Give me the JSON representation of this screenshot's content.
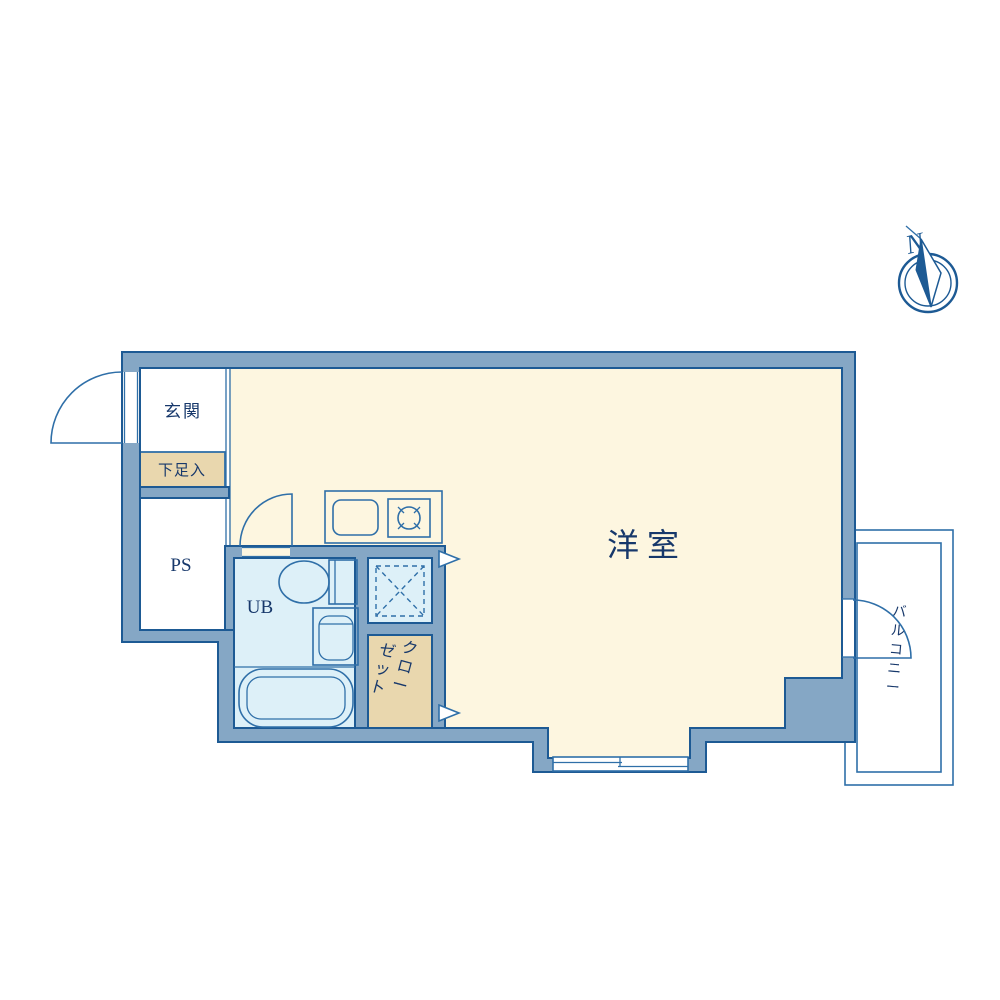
{
  "rooms": {
    "entrance": "玄関",
    "shoe_storage": "下足入",
    "pipe_space": "PS",
    "unit_bath": "UB",
    "closet_line1": "クロー",
    "closet_line2": "ゼット",
    "main_room": "洋室",
    "balcony": "バルコニー"
  },
  "compass": {
    "north": "N"
  },
  "colors": {
    "wall_fill": "#85a7c5",
    "wall_outline": "#1d5a94",
    "line": "#2f6fa8",
    "floor_cream": "#fdf6e0",
    "wet_blue": "#ddf0f8",
    "storage_tan": "#e9d7ae",
    "text_navy": "#17386b",
    "white": "#ffffff"
  }
}
